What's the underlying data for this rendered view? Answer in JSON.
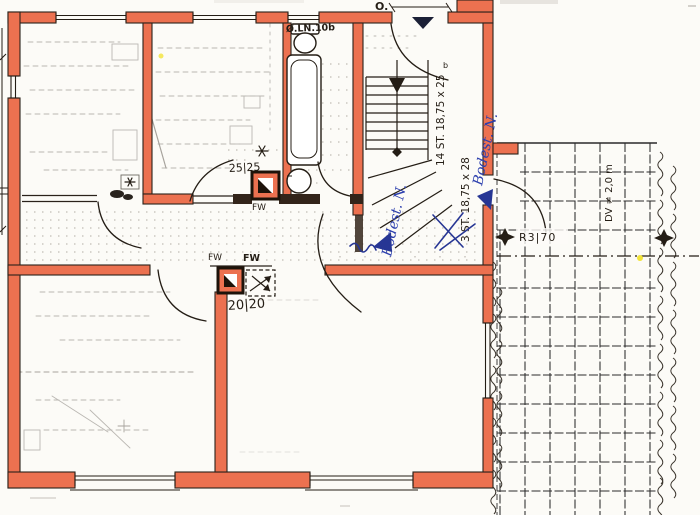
{
  "annotations": {
    "compass_mark": "O.",
    "duct_label": "Ø.LN.10b",
    "shaft_upper_dim": "25|25",
    "shaft_upper_code": "FW",
    "hall_code_left": "FW",
    "hall_code_right": "FW",
    "shaft_lower_dim": "20|20",
    "stair_main": "14 ST. 18,75 x 25",
    "stair_lower": "3 ST. 18,75 x 28",
    "note_blue_left": "Bodest. N.",
    "note_blue_right": "Bodest. N.",
    "railing_label": "R3|70",
    "terrace_label": "DV ≠ 2,0 m",
    "door_mark": "b"
  },
  "colors": {
    "wall": "#ec7150",
    "ink": "#241d15",
    "blue": "#2c3fae",
    "pencil": "#8f8b85",
    "paper": "#fcfbf7",
    "marker_yellow": "#f2e438"
  }
}
